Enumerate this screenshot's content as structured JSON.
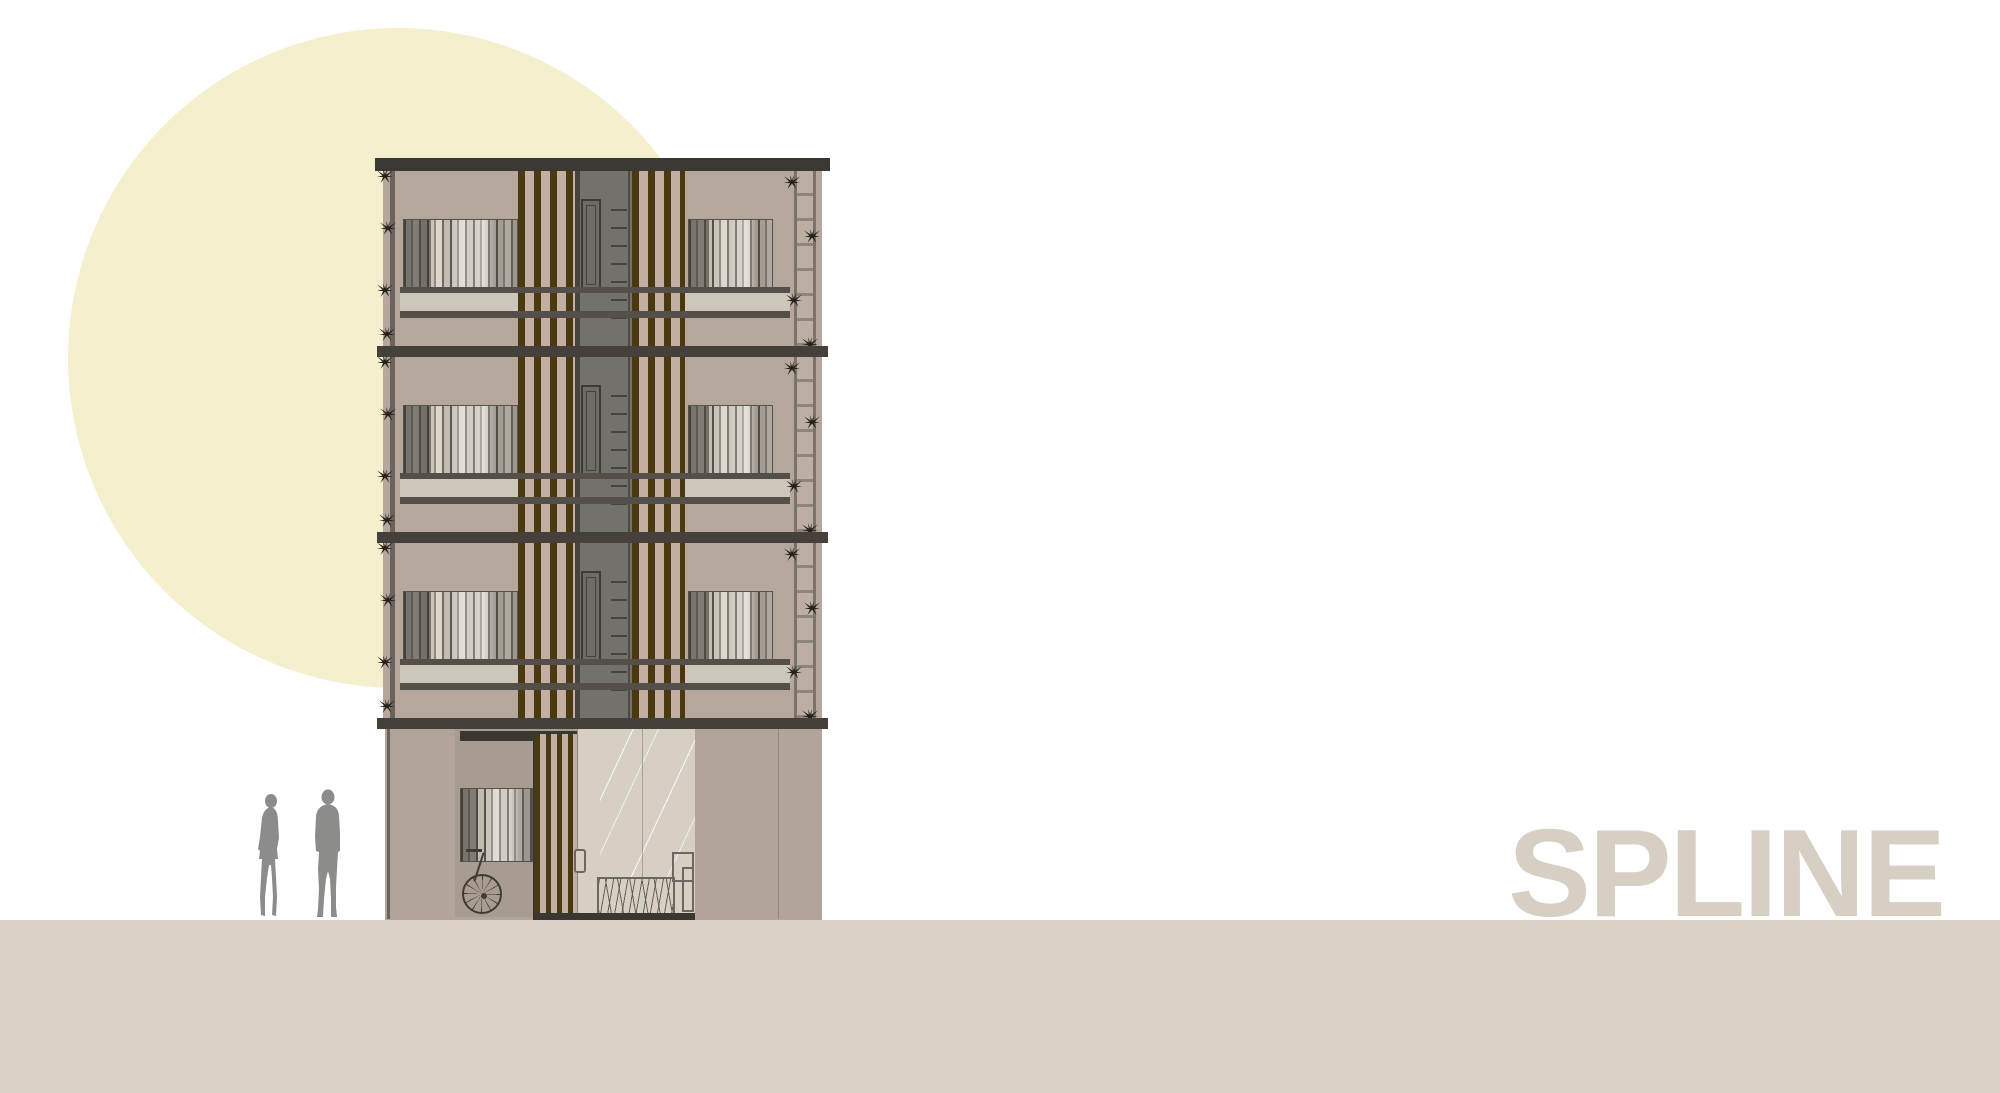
{
  "brand": {
    "name": "SPLINE"
  },
  "scene": {
    "type": "architectural-elevation",
    "floors": [
      {
        "level": 3
      },
      {
        "level": 2
      },
      {
        "level": 1
      }
    ],
    "figures": [
      {
        "id": "woman-silhouette"
      },
      {
        "id": "man-silhouette"
      }
    ],
    "ground_floor_items": [
      "window-blinds",
      "bicycle",
      "timber-slat-gate",
      "glass-entry-door",
      "glass-panel",
      "hatched-fence",
      "utility-boxes"
    ]
  },
  "colors": {
    "sun": "#f4efcd",
    "ground": "#d9d1c5",
    "brand-text": "#d7cfc3",
    "wall": "#b5a79c",
    "base-wall": "#b2a49a",
    "slat-bg": "#c2aea2",
    "deck": "#cdc6ba",
    "slat": "#4a3810",
    "slab": "#45413a",
    "roof": "#3b3833",
    "shaft": "#72716b",
    "shaft-edge": "#45443f",
    "shaft-door": "#6c6b64",
    "railing": "#554f49",
    "porch": "#a89b90",
    "lintel": "#3a3733",
    "glass": "#d7cfc4",
    "person": "#8c8c8a",
    "plant": "#23221b",
    "line": "#6e675f",
    "frame": "#55524c",
    "seam": "#8f867d",
    "col-line": "#6b645c",
    "planter-line": "#8d857c"
  }
}
